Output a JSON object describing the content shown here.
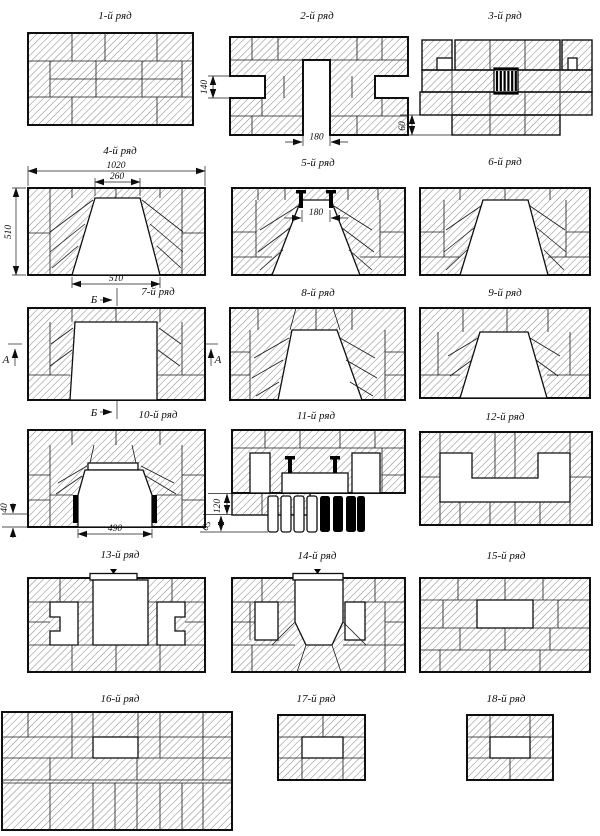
{
  "sheet": {
    "background": "#ffffff",
    "line_color": "#0f0f0f",
    "black_fill": "#000000"
  },
  "rows": [
    {
      "label": "1-й ряд"
    },
    {
      "label": "2-й ряд"
    },
    {
      "label": "3-й ряд"
    },
    {
      "label": "4-й ряд"
    },
    {
      "label": "5-й ряд"
    },
    {
      "label": "6-й ряд"
    },
    {
      "label": "7-й ряд"
    },
    {
      "label": "8-й ряд"
    },
    {
      "label": "9-й ряд"
    },
    {
      "label": "10-й ряд"
    },
    {
      "label": "11-й ряд"
    },
    {
      "label": "12-й ряд"
    },
    {
      "label": "13-й ряд"
    },
    {
      "label": "14-й ряд"
    },
    {
      "label": "15-й ряд"
    },
    {
      "label": "16-й ряд"
    },
    {
      "label": "17-й ряд"
    },
    {
      "label": "18-й ряд"
    }
  ],
  "dimensions": {
    "row2_notch_height": "140",
    "row2_channel_width": "180",
    "row3_offset": "60",
    "row4_total_width": "1020",
    "row4_top_opening": "260",
    "row4_height": "510",
    "row4_bottom_opening": "510",
    "row5_pin_spacing": "180",
    "row10_ledge": "40",
    "row10_opening_width": "490",
    "row11_upper": "120",
    "row11_lower": "65"
  },
  "section_marks": {
    "a_label": "А",
    "b_label": "Б"
  }
}
